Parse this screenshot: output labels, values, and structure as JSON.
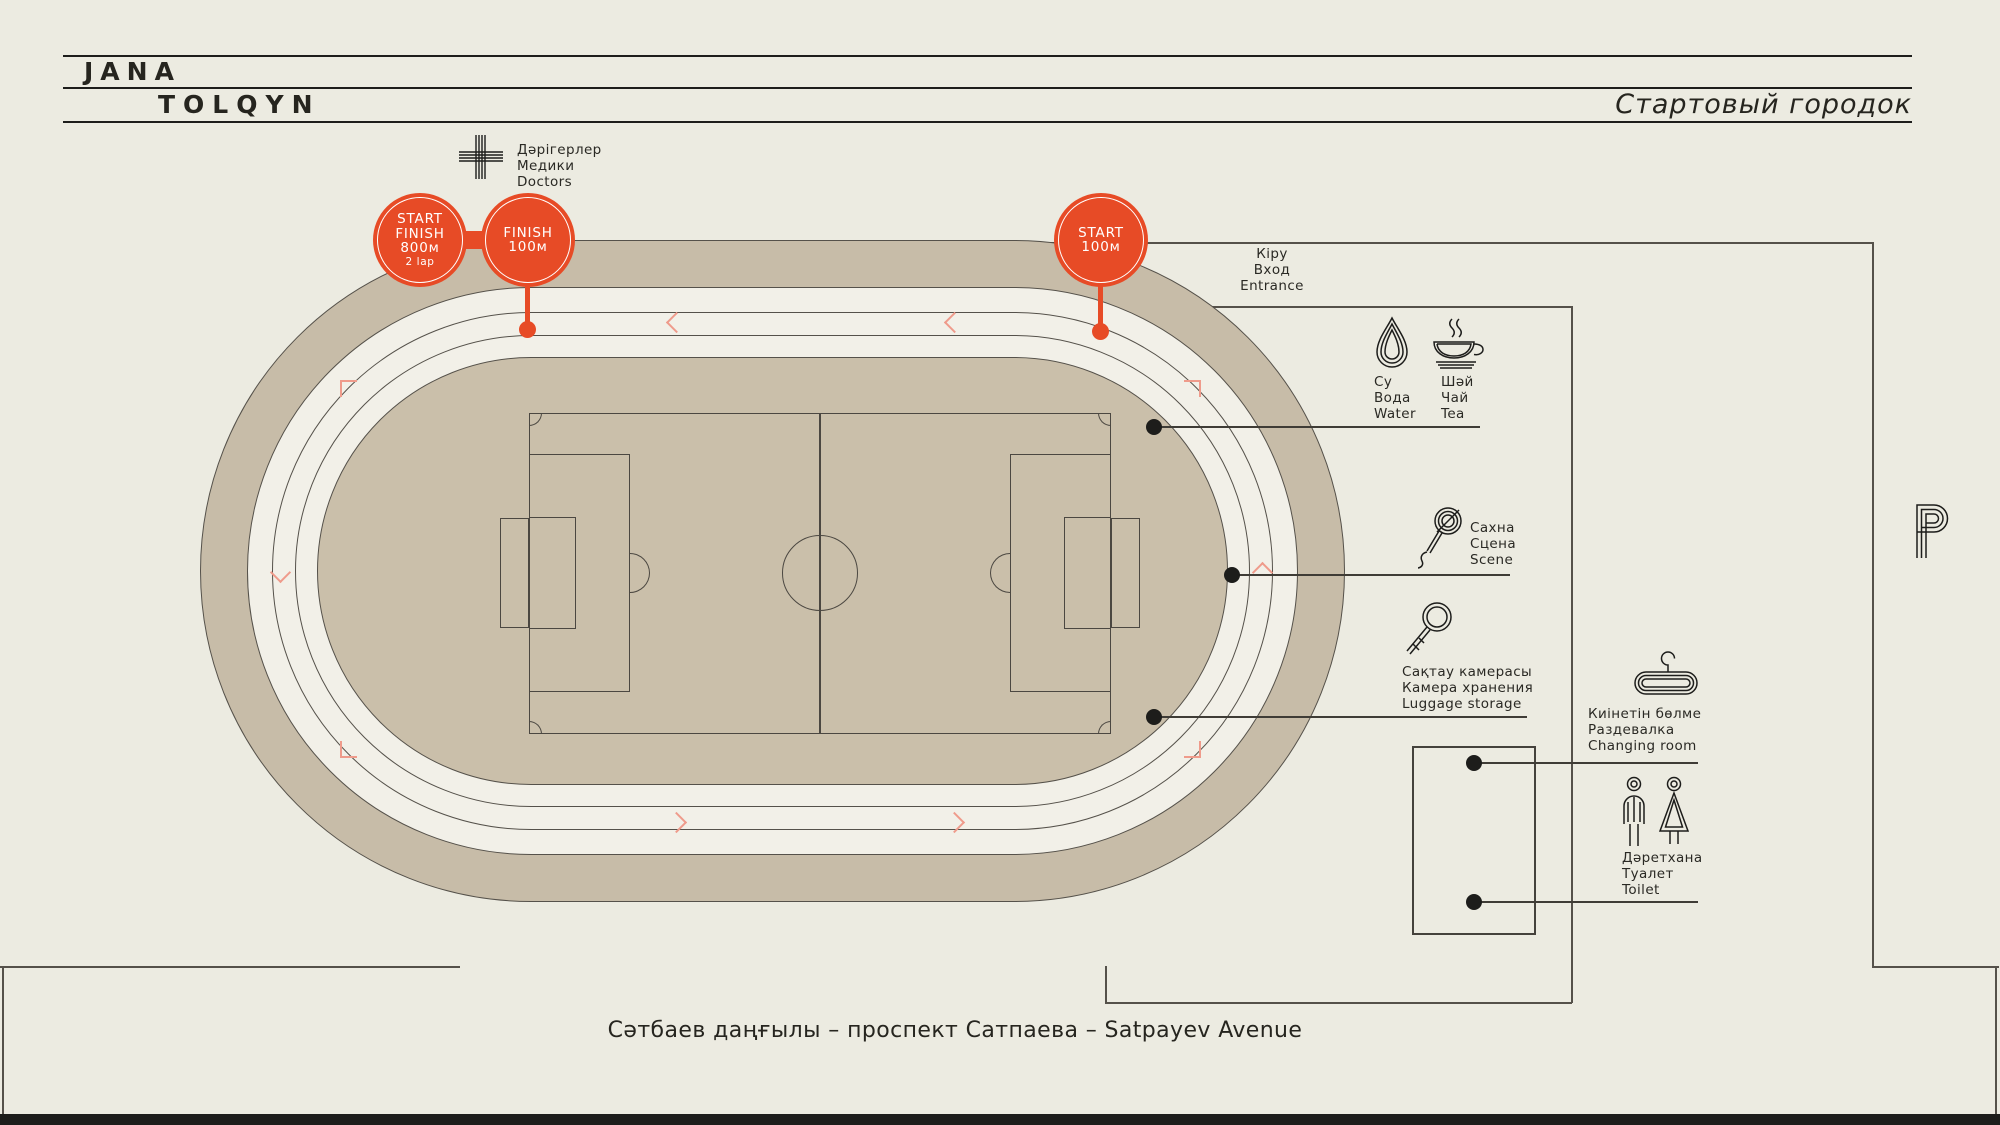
{
  "header": {
    "logo_line1": "JANA",
    "logo_line2": "TOLQYN",
    "title": "Стартовый городок"
  },
  "markers": {
    "start_finish_800": {
      "l1": "START",
      "l2": "FINISH",
      "l3": "800м",
      "l4": "2 lap"
    },
    "finish_100": {
      "l1": "FINISH",
      "l2": "100м"
    },
    "start_100": {
      "l1": "START",
      "l2": "100м"
    }
  },
  "legend": {
    "doctors": "Дәрігерлер\nМедики\nDoctors",
    "entrance": "Кіру\nВход\nEntrance",
    "water": "Су\nВода\nWater",
    "tea": "Шәй\nЧай\nTea",
    "scene": "Сахна\nСцена\nScene",
    "luggage": "Сақтау камерасы\nКамера хранения\nLuggage storage",
    "changing_room": "Киінетін бөлме\nРаздевалка\nChanging room",
    "toilet": "Дәретхана\nТуалет\nToilet"
  },
  "icons": {
    "doctors": "medical-cross-icon",
    "water": "water-drop-icon",
    "tea": "tea-cup-icon",
    "scene": "microphone-icon",
    "luggage": "key-icon",
    "changing_room": "clothes-hanger-icon",
    "toilet": "man-woman-icon",
    "parking": "parking-p-icon"
  },
  "footer": {
    "avenue": "Сәтбаев даңғылы – проспект Сатпаева – Satpayev Avenue"
  },
  "colors": {
    "background": "#ecebe1",
    "track_ring": "#c7bca8",
    "infield": "#cabfaa",
    "lanes": "#f2f0e8",
    "accent_red": "#e74b26",
    "coral": "#ef9b8b",
    "map_line": "#55514a",
    "ink": "#1d1d1b"
  }
}
